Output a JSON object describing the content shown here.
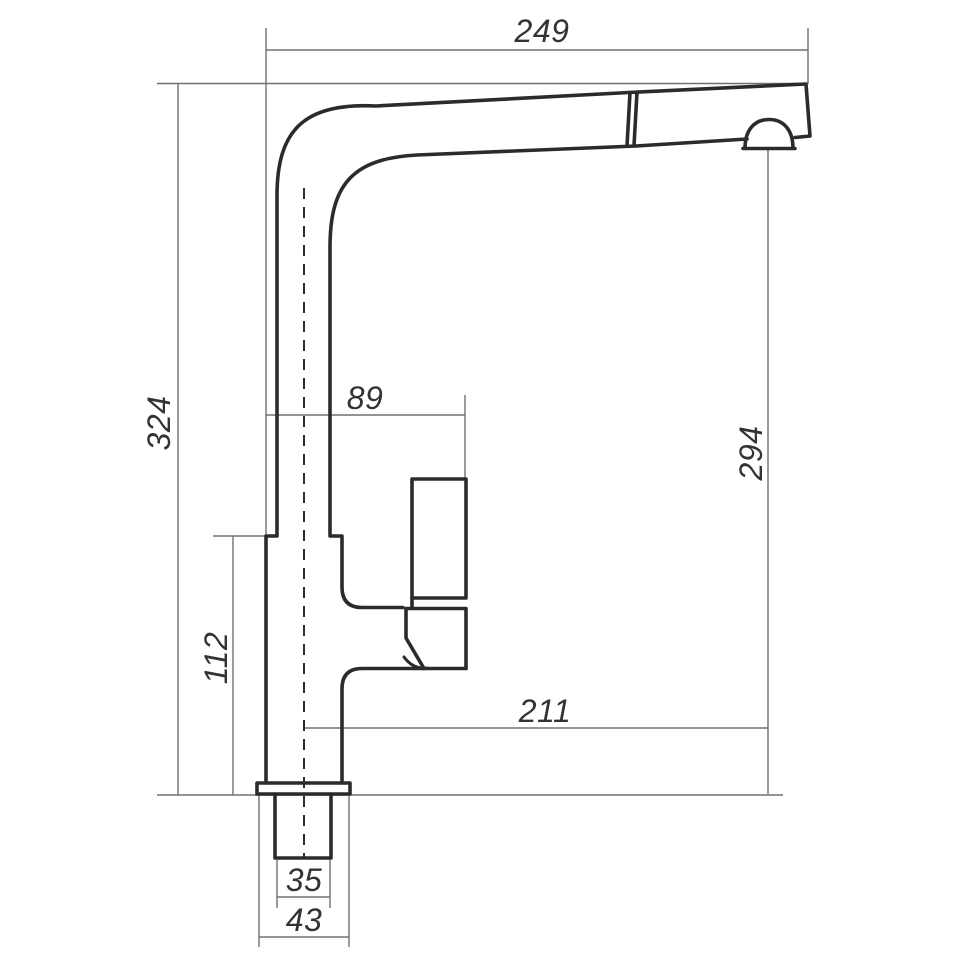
{
  "drawing": {
    "kind": "faucet-side-view-dimension-drawing",
    "background": "#ffffff"
  },
  "colors": {
    "outline": "#2b2b2b",
    "dimension_lines": "#707070",
    "text": "#333333"
  },
  "dimensions": {
    "spout_reach_top": "249",
    "overall_height": "324",
    "body_to_handle_width": "89",
    "aerator_height": "294",
    "body_height": "112",
    "center_to_aerator_reach": "211",
    "shank_width": "35",
    "flange_width": "43"
  }
}
